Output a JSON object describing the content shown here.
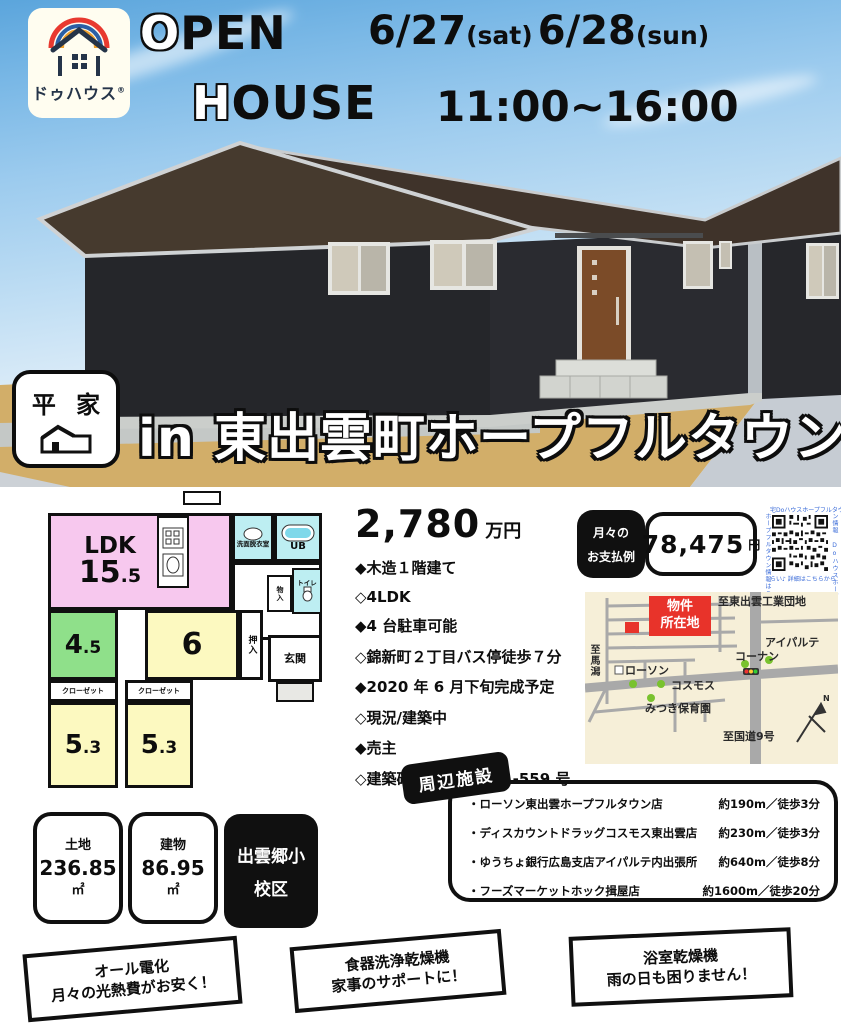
{
  "header": {
    "logo": {
      "brand": "ドゥハウス",
      "mark": "®"
    },
    "title1_first": "O",
    "title1_rest": "PEN",
    "title2_first": "H",
    "title2_rest": "OUSE",
    "date1_day": "6/27",
    "date1_dow": "(sat)",
    "date2_day": "6/28",
    "date2_dow": "(sun)",
    "time": "11:00~16:00"
  },
  "banner": {
    "badge_title": "平 家",
    "location": "in 東出雲町ホープフルタウン"
  },
  "floorplan": {
    "ldk_label": "LDK",
    "ldk_int": "15",
    "ldk_dec": ".5",
    "washroom": "洗面脱衣室",
    "ub": "UB",
    "toilet": "トイレ",
    "mono_ire": "物入",
    "oshiire": "押入",
    "genkan": "玄関",
    "room45_int": "4",
    "room45_dec": ".5",
    "room6": "6",
    "room53a_int": "5",
    "room53a_dec": ".3",
    "room53b_int": "5",
    "room53b_dec": ".3",
    "closet_a": "クローゼット",
    "closet_b": "クローゼット"
  },
  "price": {
    "amount": "2,780",
    "unit": "万円"
  },
  "features": [
    "◆木造１階建て",
    "◇4LDK",
    "◆4 台駐車可能",
    "◇錦新町２丁目バス停徒歩７分",
    "◆2020 年 6 月下旬完成予定",
    "◇現況/建築中",
    "◆売主",
    "◇建築確認番号：第 31-559 号"
  ],
  "payment": {
    "label1": "月々の",
    "label2": "お支払例",
    "amount": "78,475",
    "unit": "円"
  },
  "qr": {
    "top": "宅Doハウスホープフルタウ",
    "right": "ン情報 Doハウスホープ",
    "bottom": "らい♪ 詳細はこちらから",
    "left": "ホープフルタウン情報はこ"
  },
  "map": {
    "dest_top": "至東出雲工業団地",
    "marker_line1": "物件",
    "marker_line2": "所在地",
    "aipalte": "アイパルテ",
    "konan": "コーナン",
    "lawson": "ローソン",
    "cosmos": "コスモス",
    "mitsuki": "みつき保育園",
    "dest_left": "至馬潟",
    "dest_bottom": "至国道9号",
    "compass": "N"
  },
  "facilities": {
    "title": "周辺施設",
    "items": [
      {
        "name": "・ローソン東出雲ホープフルタウン店",
        "distance": "約190m／徒歩3分"
      },
      {
        "name": "・ディスカウントドラッグコスモス東出雲店",
        "distance": "約230m／徒歩3分"
      },
      {
        "name": "・ゆうちょ銀行広島支店アイパルテ内出張所",
        "distance": "約640m／徒歩8分"
      },
      {
        "name": "・フーズマーケットホック揖屋店",
        "distance": "約1600m／徒歩20分"
      }
    ]
  },
  "area_boxes": {
    "land": {
      "label": "土地",
      "value": "236.85",
      "unit": "㎡"
    },
    "building": {
      "label": "建物",
      "value": "86.95",
      "unit": "㎡"
    },
    "school": {
      "line1": "出雲郷小",
      "line2": "校区"
    }
  },
  "feature_banners": [
    {
      "line1": "オール電化",
      "line2": "月々の光熱費がお安く！"
    },
    {
      "line1": "食器洗浄乾燥機",
      "line2": "家事のサポートに！"
    },
    {
      "line1": "浴室乾燥機",
      "line2": "雨の日も困りません！"
    }
  ],
  "colors": {
    "sky_top": "#5ba5dc",
    "ground": "#d2ae69",
    "wall": "#26272b",
    "roof": "#423528",
    "room_ldk": "#f7c8ee",
    "room_tatami": "#8fe08a",
    "room_yellow": "#fcf9c0",
    "room_wet": "#bdeef2",
    "accent_red": "#e8332a",
    "map_bg": "#f6efd8",
    "black": "#101010",
    "rainbow": [
      "#e8392f",
      "#2b5fa5",
      "#f0a02c"
    ]
  }
}
